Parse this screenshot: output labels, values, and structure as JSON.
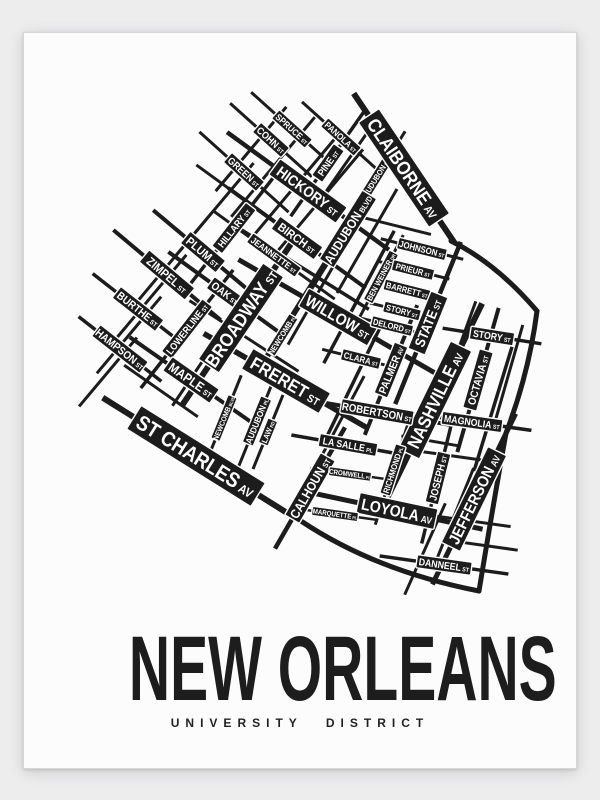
{
  "poster": {
    "title": "NEW ORLEANS",
    "subtitle": "UNIVERSITY DISTRICT",
    "colors": {
      "background": "#ededee",
      "paper": "#fcfcfc",
      "ink": "#1c1c1c",
      "label_text": "#ffffff"
    },
    "map": {
      "streets": [
        {
          "name": "SPRUCE",
          "suffix": "ST",
          "x": 291,
          "y": 128,
          "rot": 42,
          "fs": 9,
          "len": 110,
          "lw": 3
        },
        {
          "name": "PANOLA",
          "suffix": "ST",
          "x": 340,
          "y": 136,
          "rot": 42,
          "fs": 9,
          "len": 105,
          "lw": 3
        },
        {
          "name": "COHN",
          "suffix": "ST",
          "x": 270,
          "y": 139,
          "rot": 42,
          "fs": 10,
          "len": 110,
          "lw": 3
        },
        {
          "name": "GREEN",
          "suffix": "ST",
          "x": 243,
          "y": 171,
          "rot": 42,
          "fs": 10,
          "len": 120,
          "lw": 3
        },
        {
          "name": "HICKORY",
          "suffix": "ST",
          "x": 307,
          "y": 190,
          "rot": 36,
          "fs": 15,
          "len": 200,
          "lw": 4.5
        },
        {
          "name": "PINE",
          "suffix": "ST",
          "x": 327,
          "y": 162,
          "rot": -55,
          "fs": 10,
          "len": 130,
          "lw": 3.5
        },
        {
          "name": "AUDUBON",
          "suffix": "ST",
          "x": 375,
          "y": 177,
          "rot": -58,
          "fs": 8,
          "len": 110,
          "lw": 3
        },
        {
          "name": "AUDUBON",
          "suffix": "BLVD",
          "x": 347,
          "y": 228,
          "rot": -58,
          "fs": 13,
          "len": 185,
          "lw": 5
        },
        {
          "name": "BIRCH",
          "suffix": "ST",
          "x": 296,
          "y": 237,
          "rot": 36,
          "fs": 12,
          "len": 170,
          "lw": 4
        },
        {
          "name": "JEANNETTE",
          "suffix": "ST",
          "x": 273,
          "y": 254,
          "rot": 36,
          "fs": 9,
          "len": 150,
          "lw": 3
        },
        {
          "name": "HILLARY",
          "suffix": "ST",
          "x": 233,
          "y": 227,
          "rot": -52,
          "fs": 10,
          "len": 140,
          "lw": 3.5
        },
        {
          "name": "PLUM",
          "suffix": "ST",
          "x": 202,
          "y": 251,
          "rot": 40,
          "fs": 12,
          "len": 130,
          "lw": 4
        },
        {
          "name": "ZIMPEL",
          "suffix": "ST",
          "x": 166,
          "y": 274,
          "rot": 40,
          "fs": 12,
          "len": 140,
          "lw": 4
        },
        {
          "name": "OAK",
          "suffix": "ST",
          "x": 224,
          "y": 292,
          "rot": 36,
          "fs": 11,
          "len": 140,
          "lw": 4
        },
        {
          "name": "BURTHE",
          "suffix": "ST",
          "x": 137,
          "y": 308,
          "rot": 38,
          "fs": 11,
          "len": 115,
          "lw": 3.5
        },
        {
          "name": "LOWERLINE",
          "suffix": "ST",
          "x": 186,
          "y": 328,
          "rot": -52,
          "fs": 10,
          "len": 150,
          "lw": 3.5
        },
        {
          "name": "HAMPSON",
          "suffix": "ST",
          "x": 119,
          "y": 348,
          "rot": 38,
          "fs": 11,
          "len": 105,
          "lw": 3.5
        },
        {
          "name": "MAPLE",
          "suffix": "ST",
          "x": 190,
          "y": 379,
          "rot": 35,
          "fs": 13,
          "len": 150,
          "lw": 4
        },
        {
          "name": "BROADWAY",
          "suffix": "ST",
          "x": 240,
          "y": 317,
          "rot": -56,
          "fs": 19,
          "len": 210,
          "lw": 6
        },
        {
          "name": "WILLOW",
          "suffix": "ST",
          "x": 337,
          "y": 316,
          "rot": 30,
          "fs": 16,
          "len": 230,
          "lw": 5
        },
        {
          "name": "NEWCOMB",
          "suffix": "PL",
          "x": 281,
          "y": 334,
          "rot": -58,
          "fs": 8,
          "len": 95,
          "lw": 3
        },
        {
          "name": "FRERET",
          "suffix": "ST",
          "x": 285,
          "y": 380,
          "rot": 30,
          "fs": 18,
          "len": 190,
          "lw": 5.5
        },
        {
          "name": "BEN WEINER",
          "suffix": "DR",
          "x": 380,
          "y": 276,
          "rot": -62,
          "fs": 8,
          "len": 95,
          "lw": 3
        },
        {
          "name": "JOHNSON",
          "suffix": "ST",
          "x": 421,
          "y": 248,
          "rot": 14,
          "fs": 9,
          "len": 85,
          "lw": 3
        },
        {
          "name": "PRIEUR",
          "suffix": "ST",
          "x": 412,
          "y": 269,
          "rot": 14,
          "fs": 8.5,
          "len": 75,
          "lw": 3
        },
        {
          "name": "BARRETT",
          "suffix": "ST",
          "x": 406,
          "y": 289,
          "rot": 14,
          "fs": 8.5,
          "len": 72,
          "lw": 3
        },
        {
          "name": "STORY",
          "suffix": "ST",
          "x": 401,
          "y": 310,
          "rot": 14,
          "fs": 8.5,
          "len": 66,
          "lw": 3
        },
        {
          "name": "DELORD",
          "suffix": "ST",
          "x": 391,
          "y": 325,
          "rot": 14,
          "fs": 8.5,
          "len": 66,
          "lw": 3
        },
        {
          "name": "CLARA",
          "suffix": "ST",
          "x": 360,
          "y": 358,
          "rot": 14,
          "fs": 9,
          "len": 80,
          "lw": 3
        },
        {
          "name": "STATE",
          "suffix": "ST",
          "x": 427,
          "y": 322,
          "rot": -68,
          "fs": 14,
          "len": 175,
          "lw": 4.5
        },
        {
          "name": "PALMER",
          "suffix": "AV",
          "x": 390,
          "y": 369,
          "rot": -68,
          "fs": 11,
          "len": 140,
          "lw": 4
        },
        {
          "name": "STORY",
          "suffix": "ST",
          "x": 491,
          "y": 335,
          "rot": 9,
          "fs": 10,
          "len": 100,
          "lw": 3.5
        },
        {
          "name": "OCTAVIA",
          "suffix": "ST",
          "x": 477,
          "y": 379,
          "rot": -74,
          "fs": 11,
          "len": 150,
          "lw": 4
        },
        {
          "name": "NASHVILLE",
          "suffix": "AV",
          "x": 434,
          "y": 399,
          "rot": -64,
          "fs": 18,
          "len": 215,
          "lw": 6
        },
        {
          "name": "ROBERTSON",
          "suffix": "ST",
          "x": 376,
          "y": 411,
          "rot": 10,
          "fs": 11,
          "len": 150,
          "lw": 4
        },
        {
          "name": "MAGNOLIA",
          "suffix": "ST",
          "x": 471,
          "y": 421,
          "rot": 8,
          "fs": 10,
          "len": 120,
          "lw": 3.5
        },
        {
          "name": "CLAIBORNE",
          "suffix": "AV",
          "x": 403,
          "y": 167,
          "rot": 56,
          "fs": 19,
          "len": 180,
          "lw": 6
        },
        {
          "name": "ST CHARLES",
          "suffix": "AV",
          "x": 195,
          "y": 455,
          "rot": 32,
          "fs": 21,
          "len": 220,
          "lw": 6
        },
        {
          "name": "NEWCOMB",
          "suffix": "BLVD",
          "x": 223,
          "y": 417,
          "rot": -68,
          "fs": 7.5,
          "len": 92,
          "lw": 3
        },
        {
          "name": "AUDUBON",
          "suffix": "PL",
          "x": 256,
          "y": 420,
          "rot": -68,
          "fs": 9,
          "len": 105,
          "lw": 3
        },
        {
          "name": "LAW",
          "suffix": "RD",
          "x": 267,
          "y": 431,
          "rot": -68,
          "fs": 8,
          "len": 80,
          "lw": 3
        },
        {
          "name": "LA SALLE",
          "suffix": "PL",
          "x": 347,
          "y": 444,
          "rot": 10,
          "fs": 10,
          "len": 115,
          "lw": 3.5
        },
        {
          "name": "CALHOUN",
          "suffix": "ST",
          "x": 309,
          "y": 487,
          "rot": -60,
          "fs": 13,
          "len": 140,
          "lw": 4.5
        },
        {
          "name": "CROMWELL",
          "suffix": "PL",
          "x": 349,
          "y": 473,
          "rot": 8,
          "fs": 7,
          "len": 80,
          "lw": 2.5
        },
        {
          "name": "RICHMOND",
          "suffix": "PL",
          "x": 392,
          "y": 469,
          "rot": -72,
          "fs": 8.5,
          "len": 115,
          "lw": 3
        },
        {
          "name": "LOYOLA",
          "suffix": "AV",
          "x": 396,
          "y": 510,
          "rot": 12,
          "fs": 16,
          "len": 175,
          "lw": 5
        },
        {
          "name": "MARQUETTE",
          "suffix": "PL",
          "x": 334,
          "y": 513,
          "rot": 8,
          "fs": 7,
          "len": 85,
          "lw": 2.5
        },
        {
          "name": "JOSEPH",
          "suffix": "ST",
          "x": 437,
          "y": 477,
          "rot": -76,
          "fs": 10.5,
          "len": 135,
          "lw": 3.5
        },
        {
          "name": "JEFFERSON",
          "suffix": "AV",
          "x": 473,
          "y": 498,
          "rot": -64,
          "fs": 16,
          "len": 190,
          "lw": 5
        },
        {
          "name": "DANNEEL",
          "suffix": "ST",
          "x": 443,
          "y": 564,
          "rot": 8,
          "fs": 10,
          "len": 130,
          "lw": 3.5
        }
      ],
      "extra_lines": [
        {
          "x": 250,
          "y": 148,
          "rot": -50,
          "len": 110,
          "lw": 3
        },
        {
          "x": 272,
          "y": 166,
          "rot": -50,
          "len": 130,
          "lw": 3
        },
        {
          "x": 295,
          "y": 184,
          "rot": -50,
          "len": 140,
          "lw": 3
        },
        {
          "x": 317,
          "y": 202,
          "rot": -50,
          "len": 140,
          "lw": 3
        },
        {
          "x": 352,
          "y": 152,
          "rot": -55,
          "len": 100,
          "lw": 3
        },
        {
          "x": 214,
          "y": 208,
          "rot": -50,
          "len": 120,
          "lw": 3
        },
        {
          "x": 172,
          "y": 258,
          "rot": -50,
          "len": 120,
          "lw": 3
        },
        {
          "x": 150,
          "y": 296,
          "rot": -50,
          "len": 110,
          "lw": 3
        },
        {
          "x": 128,
          "y": 334,
          "rot": -50,
          "len": 100,
          "lw": 3
        },
        {
          "x": 107,
          "y": 371,
          "rot": -50,
          "len": 90,
          "lw": 3
        },
        {
          "x": 205,
          "y": 355,
          "rot": -56,
          "len": 120,
          "lw": 3
        },
        {
          "x": 256,
          "y": 208,
          "rot": 36,
          "len": 150,
          "lw": 3
        },
        {
          "x": 300,
          "y": 266,
          "rot": 32,
          "len": 160,
          "lw": 3.5
        },
        {
          "x": 243,
          "y": 335,
          "rot": 33,
          "len": 130,
          "lw": 3
        },
        {
          "x": 160,
          "y": 390,
          "rot": 35,
          "len": 90,
          "lw": 3
        },
        {
          "x": 302,
          "y": 296,
          "rot": -58,
          "len": 150,
          "lw": 3.5
        },
        {
          "x": 322,
          "y": 283,
          "rot": -60,
          "len": 140,
          "lw": 3
        },
        {
          "x": 358,
          "y": 296,
          "rot": -62,
          "len": 150,
          "lw": 3.5
        },
        {
          "x": 366,
          "y": 240,
          "rot": -60,
          "len": 120,
          "lw": 3
        },
        {
          "x": 352,
          "y": 382,
          "rot": -64,
          "len": 140,
          "lw": 3.5
        },
        {
          "x": 335,
          "y": 428,
          "rot": -62,
          "len": 120,
          "lw": 3
        },
        {
          "x": 456,
          "y": 352,
          "rot": -70,
          "len": 110,
          "lw": 3
        },
        {
          "x": 492,
          "y": 408,
          "rot": -73,
          "len": 130,
          "lw": 3.5
        },
        {
          "x": 508,
          "y": 372,
          "rot": -74,
          "len": 100,
          "lw": 3
        },
        {
          "x": 452,
          "y": 518,
          "rot": -68,
          "len": 110,
          "lw": 3
        },
        {
          "x": 424,
          "y": 548,
          "rot": -66,
          "len": 100,
          "lw": 3
        },
        {
          "x": 452,
          "y": 455,
          "rot": 8,
          "len": 70,
          "lw": 3
        },
        {
          "x": 470,
          "y": 520,
          "rot": 8,
          "len": 80,
          "lw": 3
        },
        {
          "x": 487,
          "y": 545,
          "rot": 8,
          "len": 60,
          "lw": 3
        },
        {
          "x": 430,
          "y": 440,
          "rot": 10,
          "len": 60,
          "lw": 3
        },
        {
          "x": 396,
          "y": 225,
          "rot": 14,
          "len": 70,
          "lw": 3
        }
      ],
      "boundaries": [
        "M 450 240 Q 495 262 536 310",
        "M 536 310 Q 528 372 505 432 Q 492 505 478 590",
        "M 300 520 Q 375 570 478 590"
      ]
    }
  }
}
